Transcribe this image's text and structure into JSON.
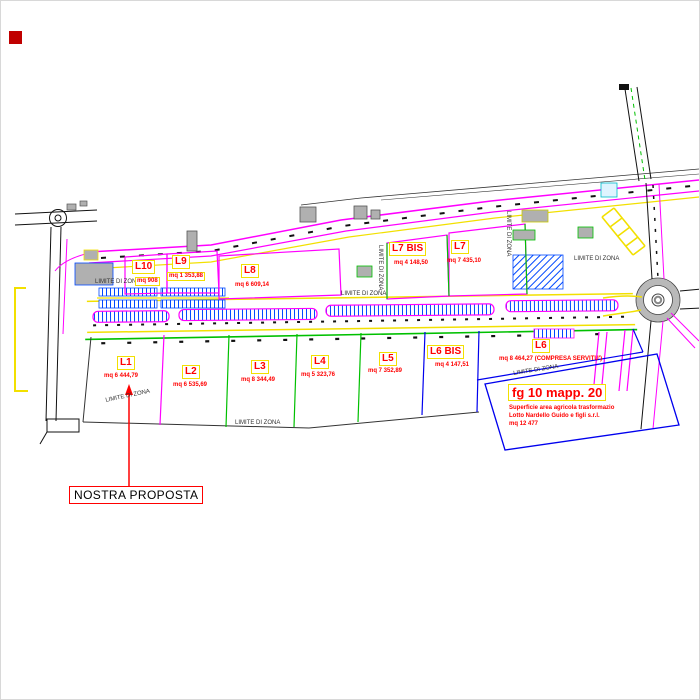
{
  "lots": [
    {
      "id": "L1",
      "area": "mq 6 444,79"
    },
    {
      "id": "L2",
      "area": "mq 6 535,69"
    },
    {
      "id": "L3",
      "area": "mq 8 344,49"
    },
    {
      "id": "L4",
      "area": "mq 5 323,76"
    },
    {
      "id": "L5",
      "area": "mq 7 352,89"
    },
    {
      "id": "L6 BIS",
      "area": "mq 4 147,51"
    },
    {
      "id": "L6",
      "area": "mq 8 464,27 (COMPRESA SERVITU')"
    },
    {
      "id": "L7",
      "area": "mq 7 435,10"
    },
    {
      "id": "L7 BIS",
      "area": "mq 4 148,50"
    },
    {
      "id": "L8",
      "area": "mq 6 609,14"
    },
    {
      "id": "L9",
      "area": "mq 1 353,88"
    },
    {
      "id": "L10",
      "area": "mq 908"
    }
  ],
  "parcel_note": {
    "title": "fg 10 mapp. 20",
    "line1": "Superficie area agricola trasformazio",
    "line2": "Lotto Nardello Guido e figli s.r.l.",
    "line3": "mq 12 477"
  },
  "annotation": {
    "proposal": "NOSTRA PROPOSTA"
  },
  "boundary_label": "LIMITE DI ZONA",
  "colors": {
    "parcel_magenta": "#ff00ff",
    "road_yellow": "#f2e000",
    "lot_green": "#00c000",
    "parcel_blue": "#0000ee",
    "label_red": "#ff0000",
    "building_gray": "#b0b0b0"
  }
}
